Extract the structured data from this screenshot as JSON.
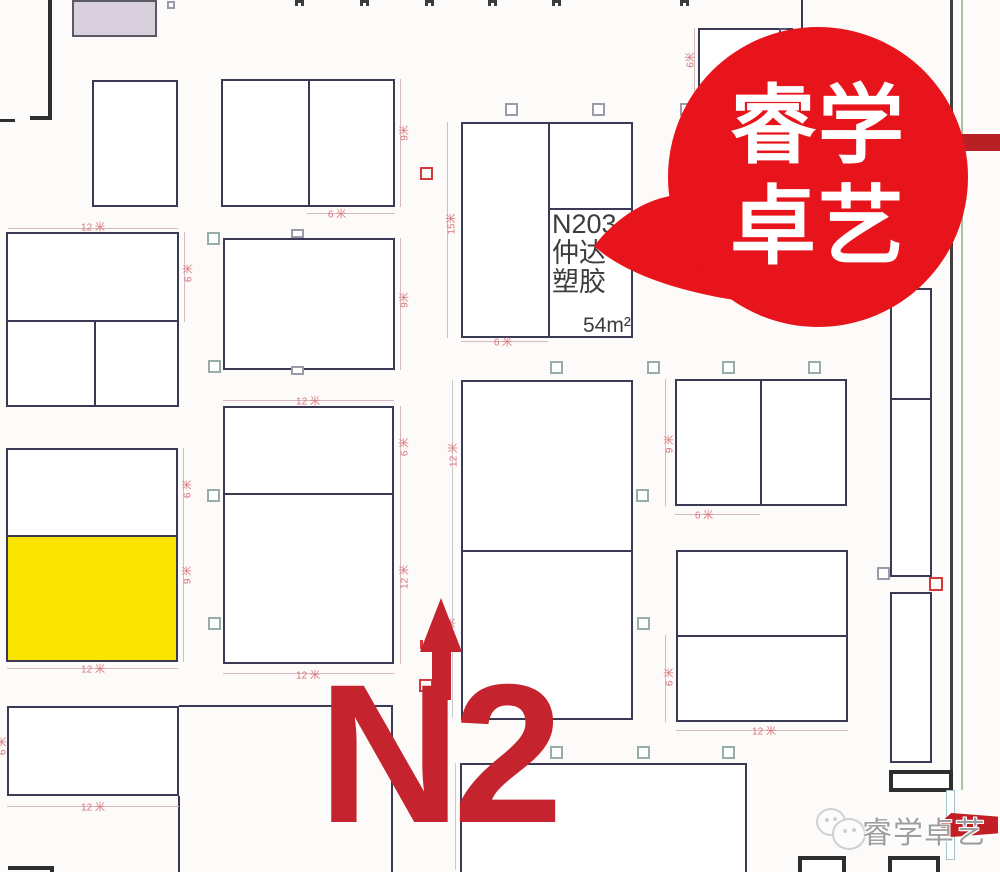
{
  "hall": {
    "label": "N2"
  },
  "bubble": {
    "line1": "睿学",
    "line2": "卓艺"
  },
  "booth_n203": {
    "id": "N203",
    "name_line1": "仲达",
    "name_line2": "塑胶",
    "area": "54m²"
  },
  "watermark": {
    "text": "睿学卓艺"
  },
  "colors": {
    "bubble_red": "#e8141b",
    "label_red": "#c5242f",
    "highlight_yellow": "#f8e400",
    "dimension_pink": "#d9737a",
    "booth_border": "#3a3a55"
  },
  "dimensions": [
    {
      "text": "12 米",
      "x": 93,
      "y": 226,
      "v": false
    },
    {
      "text": "6 米",
      "x": 187,
      "y": 273,
      "v": true
    },
    {
      "text": "6 米",
      "x": 186,
      "y": 489,
      "v": true
    },
    {
      "text": "9 米",
      "x": 186,
      "y": 575,
      "v": true
    },
    {
      "text": "12 米",
      "x": 93,
      "y": 668,
      "v": false
    },
    {
      "text": "6 米",
      "x": 1,
      "y": 746,
      "v": true
    },
    {
      "text": "12 米",
      "x": 93,
      "y": 806,
      "v": false
    },
    {
      "text": "9米",
      "x": 403,
      "y": 133,
      "v": true
    },
    {
      "text": "6 米",
      "x": 337,
      "y": 213,
      "v": false
    },
    {
      "text": "9米",
      "x": 403,
      "y": 300,
      "v": true
    },
    {
      "text": "12 米",
      "x": 308,
      "y": 400,
      "v": false
    },
    {
      "text": "6 米",
      "x": 403,
      "y": 447,
      "v": true
    },
    {
      "text": "12 米",
      "x": 403,
      "y": 577,
      "v": true
    },
    {
      "text": "12 米",
      "x": 308,
      "y": 674,
      "v": false
    },
    {
      "text": "15米",
      "x": 450,
      "y": 224,
      "v": true
    },
    {
      "text": "6 米",
      "x": 503,
      "y": 341,
      "v": false
    },
    {
      "text": "12 米",
      "x": 452,
      "y": 455,
      "v": true
    },
    {
      "text": "12 米",
      "x": 450,
      "y": 630,
      "v": true
    },
    {
      "text": "9 米",
      "x": 668,
      "y": 444,
      "v": true
    },
    {
      "text": "6 米",
      "x": 704,
      "y": 514,
      "v": false
    },
    {
      "text": "6 米",
      "x": 668,
      "y": 677,
      "v": true
    },
    {
      "text": "12 米",
      "x": 764,
      "y": 730,
      "v": false
    },
    {
      "text": "6米",
      "x": 689,
      "y": 60,
      "v": true
    }
  ]
}
